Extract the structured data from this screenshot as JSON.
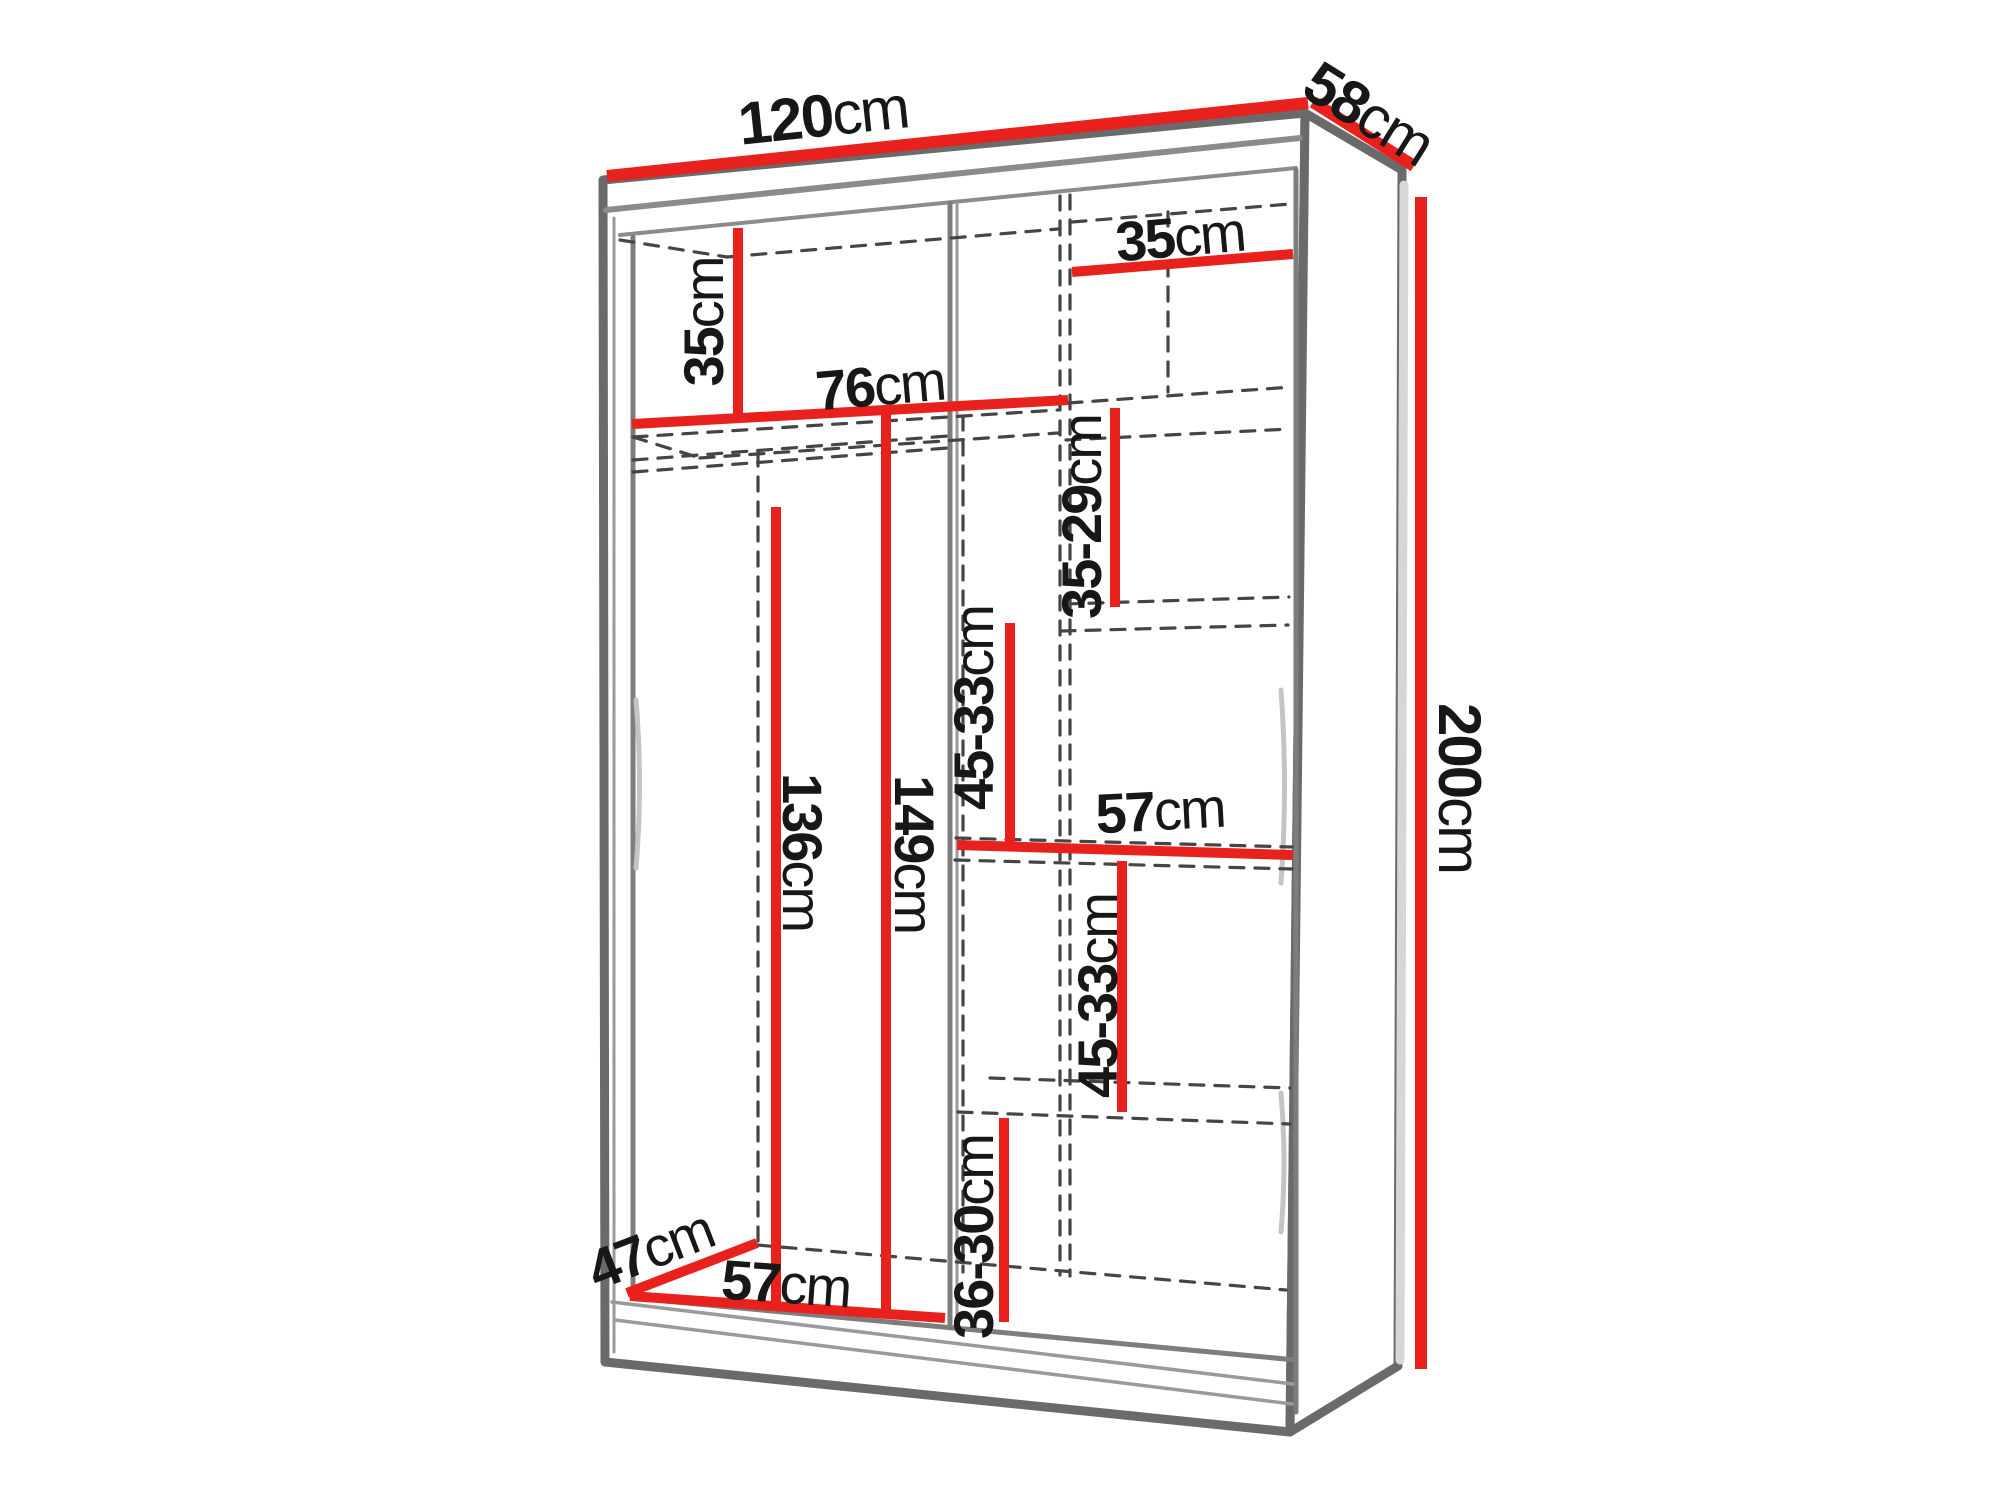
{
  "diagram": {
    "type": "wardrobe-dimension-diagram",
    "unit": "cm",
    "overall_dimensions": {
      "width": "120cm",
      "depth": "58cm",
      "height": "200cm"
    },
    "colors": {
      "accent": "#e8211d",
      "structure": "#6a6a6a",
      "structure_light": "#9a9a9a",
      "dashed": "#454545",
      "text": "#171717",
      "glare": "#c4c4c4",
      "background": "#ffffff"
    },
    "labels": [
      {
        "id": "width-top",
        "number": "120",
        "unit": "cm",
        "x": 823,
        "y": 115,
        "rot": -6,
        "size": 60
      },
      {
        "id": "depth-top",
        "number": "58",
        "unit": "cm",
        "x": 1369,
        "y": 113,
        "rot": 32,
        "size": 60
      },
      {
        "id": "height-right",
        "number": "200",
        "unit": "cm",
        "x": 1460,
        "y": 788,
        "rot": 90,
        "size": 60
      },
      {
        "id": "top-left-compartment",
        "number": "35",
        "unit": "cm",
        "x": 703,
        "y": 322,
        "rot": -90,
        "size": 56
      },
      {
        "id": "left-section-width",
        "number": "76",
        "unit": "cm",
        "x": 880,
        "y": 385,
        "rot": -5,
        "size": 56
      },
      {
        "id": "right-column-width",
        "number": "35",
        "unit": "cm",
        "x": 1180,
        "y": 236,
        "rot": -5,
        "size": 56
      },
      {
        "id": "shelf-gap-35-29",
        "number": "35-29",
        "unit": "cm",
        "x": 1081,
        "y": 517,
        "rot": -90,
        "size": 56
      },
      {
        "id": "shelf-gap-45-33-upper",
        "number": "45-33",
        "unit": "cm",
        "x": 973,
        "y": 708,
        "rot": -90,
        "size": 56
      },
      {
        "id": "rail-height-149",
        "number": "149",
        "unit": "cm",
        "x": 915,
        "y": 854,
        "rot": 90,
        "size": 56
      },
      {
        "id": "rod-height-136",
        "number": "136",
        "unit": "cm",
        "x": 803,
        "y": 852,
        "rot": 90,
        "size": 56
      },
      {
        "id": "shelf-width-57-mid",
        "number": "57",
        "unit": "cm",
        "x": 1160,
        "y": 810,
        "rot": -3,
        "size": 56
      },
      {
        "id": "shelf-gap-45-33-lower",
        "number": "45-33",
        "unit": "cm",
        "x": 1097,
        "y": 996,
        "rot": -90,
        "size": 56
      },
      {
        "id": "shelf-gap-36-30",
        "number": "36-30",
        "unit": "cm",
        "x": 973,
        "y": 1237,
        "rot": -90,
        "size": 56
      },
      {
        "id": "floor-depth-47",
        "number": "47",
        "unit": "cm",
        "x": 650,
        "y": 1249,
        "rot": -21,
        "size": 56
      },
      {
        "id": "floor-width-57",
        "number": "57",
        "unit": "cm",
        "x": 786,
        "y": 1283,
        "rot": 4,
        "size": 56
      }
    ],
    "dimension_lines": [
      {
        "id": "width-120",
        "x1": 607,
        "y1": 176,
        "x2": 1308,
        "y2": 103,
        "w": 12
      },
      {
        "id": "depth-58",
        "x1": 1313,
        "y1": 102,
        "x2": 1414,
        "y2": 166,
        "w": 12
      },
      {
        "id": "height-200",
        "x1": 1421,
        "y1": 197,
        "x2": 1421,
        "y2": 1369,
        "w": 12
      },
      {
        "id": "comp-35-left",
        "x1": 738,
        "y1": 228,
        "x2": 738,
        "y2": 419,
        "w": 10
      },
      {
        "id": "width-76",
        "x1": 632,
        "y1": 424,
        "x2": 1068,
        "y2": 400,
        "w": 10
      },
      {
        "id": "width-35-right",
        "x1": 1072,
        "y1": 272,
        "x2": 1293,
        "y2": 254,
        "w": 10
      },
      {
        "id": "gap-35-29",
        "x1": 1115,
        "y1": 408,
        "x2": 1115,
        "y2": 607,
        "w": 10
      },
      {
        "id": "gap-45-33-up",
        "x1": 1010,
        "y1": 623,
        "x2": 1010,
        "y2": 846,
        "w": 10
      },
      {
        "id": "width-57-mid",
        "x1": 957,
        "y1": 845,
        "x2": 1293,
        "y2": 855,
        "w": 10
      },
      {
        "id": "height-149",
        "x1": 886,
        "y1": 410,
        "x2": 886,
        "y2": 1317,
        "w": 10
      },
      {
        "id": "height-136",
        "x1": 776,
        "y1": 507,
        "x2": 776,
        "y2": 1306,
        "w": 10
      },
      {
        "id": "gap-45-33-low",
        "x1": 1122,
        "y1": 861,
        "x2": 1122,
        "y2": 1112,
        "w": 10
      },
      {
        "id": "gap-36-30",
        "x1": 1004,
        "y1": 1118,
        "x2": 1004,
        "y2": 1322,
        "w": 10
      },
      {
        "id": "depth-47",
        "x1": 627,
        "y1": 1293,
        "x2": 757,
        "y2": 1243,
        "w": 10
      },
      {
        "id": "width-57-bottom",
        "x1": 630,
        "y1": 1296,
        "x2": 945,
        "y2": 1318,
        "w": 10
      }
    ]
  }
}
